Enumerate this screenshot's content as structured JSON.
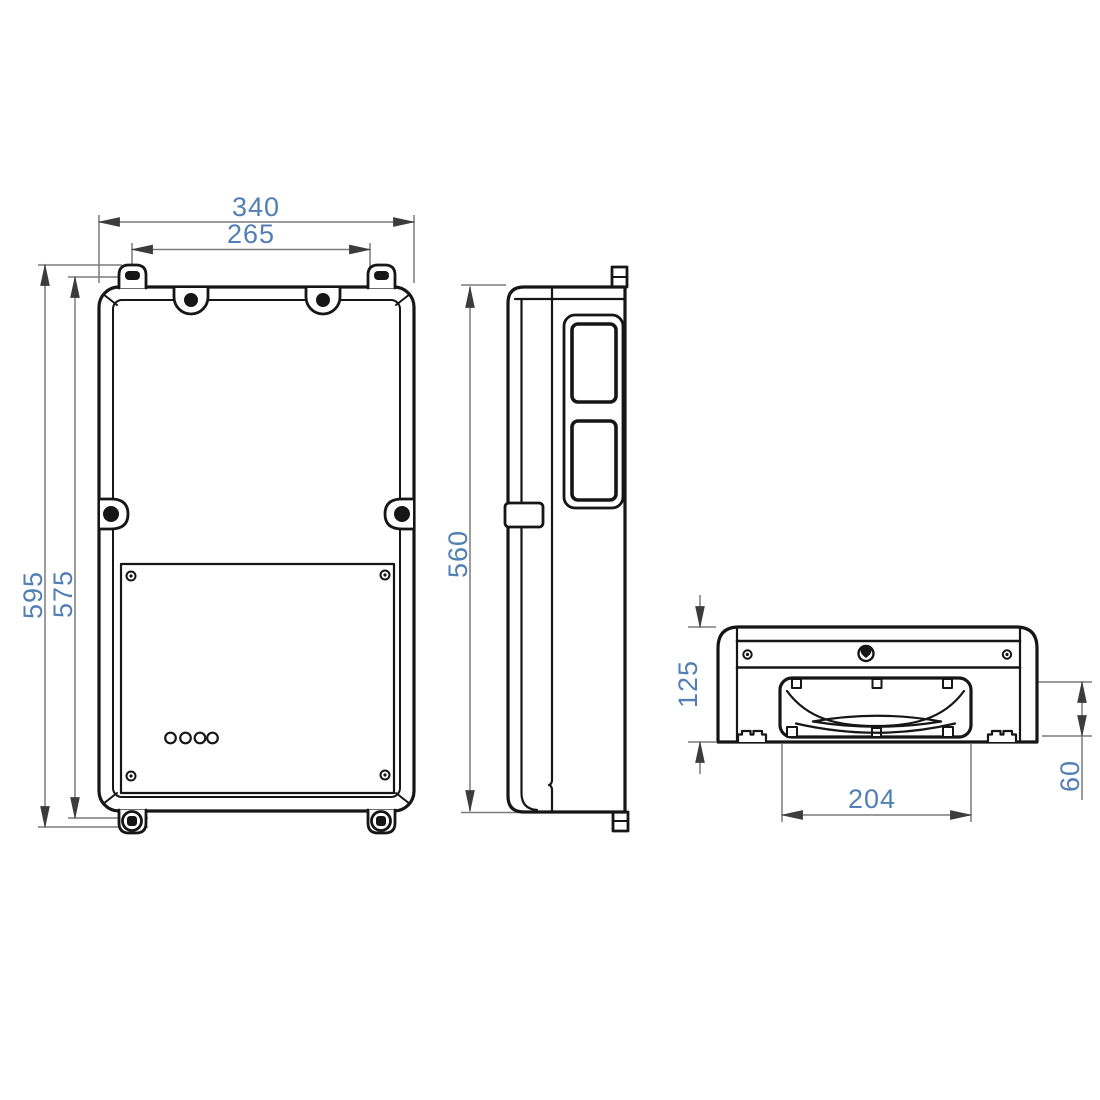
{
  "drawing": {
    "background_color": "#ffffff",
    "outline_color": "#161616",
    "dimension_line_color": "#7b7b7b",
    "arrow_color": "#3c3c3c",
    "dimension_text_color": "#527fb4",
    "views": {
      "front": {
        "dimensions": {
          "overall_width": "340",
          "top_tab_spacing": "265",
          "overall_height": "595",
          "body_height": "575"
        }
      },
      "side": {
        "dimensions": {
          "body_height": "560"
        }
      },
      "bottom": {
        "dimensions": {
          "overall_depth": "125",
          "recess_depth": "60",
          "recess_width": "204"
        }
      }
    }
  }
}
